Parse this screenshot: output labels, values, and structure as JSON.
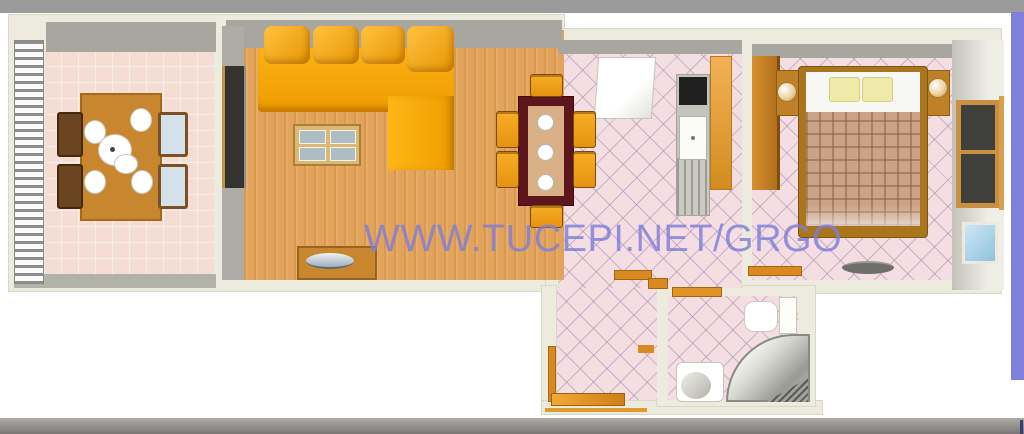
{
  "watermark": {
    "text": "WWW.TUCEPI.NET/GRGO",
    "color": "#7e7edb"
  },
  "frame": {
    "top_bar_color": "#9b9b9b",
    "bottom_bar_color": "#8f8c89",
    "right_bar_color": "#7d81d9",
    "background": "#ffffff"
  },
  "palette": {
    "wall": "#edebdd",
    "wall_face_shadow": "#a7a79f",
    "terrace_tile": "#f6ddd3",
    "diagonal_tile": "#f5dee2",
    "wood_floor": "#e2a45c",
    "sofa_orange": "#f7a606",
    "wood_furniture": "#c8872f",
    "dining_table_dark_red": "#5c161c",
    "chair_orange": "#f2a41c",
    "bed_frame": "#a9761d",
    "blanket_plaid": "#cba488",
    "pillow_yellow": "#f0eaaa",
    "door_orange": "#d88a20"
  },
  "rooms": [
    {
      "id": "terrace",
      "items": [
        "railing",
        "dining-table",
        "plates",
        "chairs"
      ]
    },
    {
      "id": "living-room",
      "items": [
        "corner-sofa",
        "coffee-table",
        "terrace-door",
        "sideboard"
      ]
    },
    {
      "id": "kitchen-dining",
      "items": [
        "dining-table",
        "chairs",
        "fridge",
        "stove",
        "sink",
        "kitchen-counter"
      ]
    },
    {
      "id": "bedroom",
      "items": [
        "wardrobe",
        "double-bed",
        "pillows",
        "nightstands",
        "lamps",
        "window"
      ]
    },
    {
      "id": "hallway",
      "items": [
        "doors"
      ]
    },
    {
      "id": "bathroom",
      "items": [
        "toilet",
        "shower",
        "washbasin"
      ]
    }
  ]
}
